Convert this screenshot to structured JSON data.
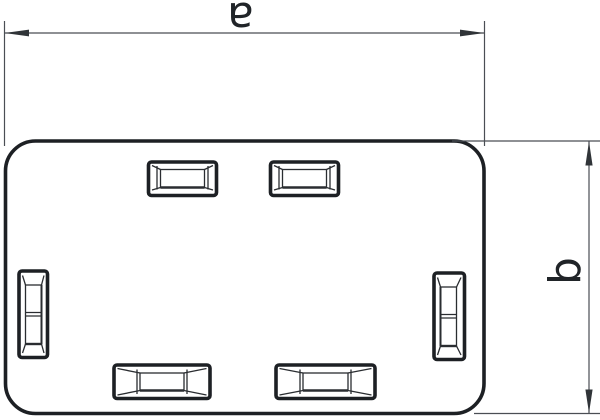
{
  "dimensions": {
    "a": {
      "label": "a"
    },
    "b": {
      "label": "b"
    }
  },
  "colors": {
    "bg": "#ffffff",
    "line": "#1d2024",
    "inner": "#2a2d31",
    "dim": "#4a4e54",
    "arrow": "#303438",
    "text": "#202428"
  }
}
